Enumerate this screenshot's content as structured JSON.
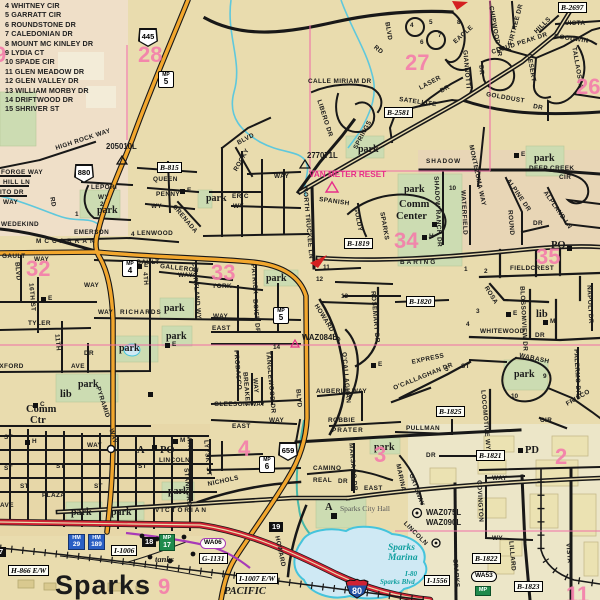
{
  "colors": {
    "bg": "#e9dcae",
    "bg_nw": "#efdfc8",
    "bg_se": "#ece6c8",
    "park": "#ccdcb2",
    "water_fill": "#cfe9f4",
    "water_line": "#45c4dc",
    "road": "#181818",
    "orange": "#f2a72e",
    "freeway": "#cf2233",
    "pink_line": "#f06ea6",
    "grid_pink": "#f47fab",
    "magenta": "#e82e8a",
    "purple": "#a83ab8",
    "building": "#ebe2b2"
  },
  "street_index": {
    "items": [
      "4  WHITNEY CIR",
      "5  GARRATT CIR",
      "6  ROUNDSTONE DR",
      "7  CALEDONIAN DR",
      "8  MOUNT MC KINLEY DR",
      "9  LYDIA CT",
      "10 SPADE CIR",
      "11 GLEN MEADOW DR",
      "12 GLEN VALLEY DR",
      "13 WILLIAM MORBY DR",
      "14 DRIFTWOOD DR",
      "15 SHRIVER ST"
    ]
  },
  "city": {
    "name": "Sparks"
  },
  "city_hall": {
    "marker": "A",
    "label": "Sparks City Hall"
  },
  "marina": {
    "line1": "Sparks",
    "line2": "Marina"
  },
  "i80_note": {
    "line1": "I-80",
    "line2": "Sparks Blvd"
  },
  "grid_numbers": [
    {
      "t": "9",
      "x": -6,
      "y": 44
    },
    {
      "t": "28",
      "x": 138,
      "y": 44
    },
    {
      "t": "27",
      "x": 405,
      "y": 52
    },
    {
      "t": "26",
      "x": 576,
      "y": 76
    },
    {
      "t": "32",
      "x": 26,
      "y": 258
    },
    {
      "t": "33",
      "x": 211,
      "y": 262
    },
    {
      "t": "34",
      "x": 394,
      "y": 230
    },
    {
      "t": "35",
      "x": 536,
      "y": 246
    },
    {
      "t": "4",
      "x": 238,
      "y": 438
    },
    {
      "t": "3",
      "x": 374,
      "y": 444
    },
    {
      "t": "2",
      "x": 555,
      "y": 446
    },
    {
      "t": "9",
      "x": 158,
      "y": 576
    },
    {
      "t": "11",
      "x": 566,
      "y": 584
    }
  ],
  "monuments": [
    {
      "t": "205010L",
      "x": 106,
      "y": 143
    },
    {
      "t": "277071L",
      "x": 307,
      "y": 152
    },
    {
      "t": "VAN METER RESET",
      "x": 309,
      "y": 171,
      "s": "vmr"
    },
    {
      "t": "WAZ084L",
      "x": 302,
      "y": 334
    },
    {
      "t": "WAZ075L",
      "x": 426,
      "y": 509
    },
    {
      "t": "WAZ090L",
      "x": 426,
      "y": 519
    }
  ],
  "ref_boxes": [
    {
      "t": "B-815",
      "x": 157,
      "y": 162
    },
    {
      "t": "B-2581",
      "x": 384,
      "y": 107
    },
    {
      "t": "B-2697",
      "x": 558,
      "y": 2
    },
    {
      "t": "B-1819",
      "x": 344,
      "y": 238
    },
    {
      "t": "B-1820",
      "x": 406,
      "y": 296
    },
    {
      "t": "B-1825",
      "x": 436,
      "y": 406
    },
    {
      "t": "B-1821",
      "x": 476,
      "y": 450
    },
    {
      "t": "B-1822",
      "x": 472,
      "y": 553
    },
    {
      "t": "B-1823",
      "x": 514,
      "y": 581
    },
    {
      "t": "H-866 E/W",
      "x": 8,
      "y": 565
    },
    {
      "t": "I-1006",
      "x": 111,
      "y": 545
    },
    {
      "t": "G-1131",
      "x": 199,
      "y": 553
    },
    {
      "t": "I-1007 E/W",
      "x": 236,
      "y": 573
    },
    {
      "t": "I-1556",
      "x": 424,
      "y": 575
    }
  ],
  "shields": [
    {
      "t": "445",
      "x": 138,
      "y": 28
    },
    {
      "t": "880",
      "x": 74,
      "y": 164
    },
    {
      "t": "659",
      "x": 278,
      "y": 442
    }
  ],
  "interstate": [
    {
      "t": "80",
      "x": 345,
      "y": 578
    }
  ],
  "mile_boxes": [
    {
      "a": "MP",
      "b": "5",
      "x": 158,
      "y": 71
    },
    {
      "a": "MP",
      "b": "4",
      "x": 122,
      "y": 260
    },
    {
      "a": "MP",
      "b": "5",
      "x": 273,
      "y": 307
    },
    {
      "a": "MP",
      "b": "6",
      "x": 259,
      "y": 456
    }
  ],
  "hm_boxes": [
    {
      "a": "HM",
      "b": "29",
      "x": 68,
      "y": 534
    },
    {
      "a": "HM",
      "b": "189",
      "x": 88,
      "y": 534
    }
  ],
  "green_boxes": [
    {
      "a": "MP",
      "b": "17",
      "x": 159,
      "y": 534
    },
    {
      "a": "MP",
      "b": "",
      "x": 475,
      "y": 586
    }
  ],
  "black_boxes": [
    {
      "t": "18",
      "x": 142,
      "y": 537
    },
    {
      "t": "19",
      "x": 269,
      "y": 522
    },
    {
      "t": "7",
      "x": -4,
      "y": 547
    }
  ],
  "ovals": [
    {
      "t": "WA06",
      "x": 200,
      "y": 538,
      "c": "p"
    },
    {
      "t": "WA53",
      "x": 471,
      "y": 571,
      "c": "k"
    }
  ],
  "places": [
    {
      "t": "Comm",
      "x": 399,
      "y": 200
    },
    {
      "t": "Center",
      "x": 396,
      "y": 212
    },
    {
      "t": "Comm",
      "x": 26,
      "y": 405
    },
    {
      "t": "Ctr",
      "x": 30,
      "y": 416
    },
    {
      "t": "PO",
      "x": 551,
      "y": 241
    },
    {
      "t": "PO",
      "x": 160,
      "y": 446
    },
    {
      "t": "PD",
      "x": 525,
      "y": 446
    },
    {
      "t": "lib",
      "x": 60,
      "y": 390
    },
    {
      "t": "lib",
      "x": 536,
      "y": 310
    },
    {
      "t": "A",
      "x": 137,
      "y": 446
    },
    {
      "t": "tanks",
      "x": 155,
      "y": 555,
      "s": "ital"
    },
    {
      "t": "PACIFIC",
      "x": 224,
      "y": 587,
      "s": "ital2"
    }
  ],
  "park_labels": [
    {
      "t": "park",
      "x": 97,
      "y": 206
    },
    {
      "t": "park",
      "x": 206,
      "y": 194
    },
    {
      "t": "park",
      "x": 358,
      "y": 145
    },
    {
      "t": "park",
      "x": 534,
      "y": 154
    },
    {
      "t": "park",
      "x": 404,
      "y": 185
    },
    {
      "t": "park",
      "x": 266,
      "y": 274
    },
    {
      "t": "park",
      "x": 164,
      "y": 304
    },
    {
      "t": "park",
      "x": 166,
      "y": 332
    },
    {
      "t": "park",
      "x": 119,
      "y": 344
    },
    {
      "t": "park",
      "x": 78,
      "y": 380
    },
    {
      "t": "park",
      "x": 71,
      "y": 508
    },
    {
      "t": "park",
      "x": 111,
      "y": 508
    },
    {
      "t": "park",
      "x": 168,
      "y": 487
    },
    {
      "t": "park",
      "x": 514,
      "y": 370
    },
    {
      "t": "park",
      "x": 374,
      "y": 443
    }
  ],
  "poi": [
    {
      "t": "E",
      "x": 137,
      "y": 264
    },
    {
      "t": "E",
      "x": 41,
      "y": 297
    },
    {
      "t": "E",
      "x": 165,
      "y": 343
    },
    {
      "t": "E",
      "x": 506,
      "y": 312
    },
    {
      "t": "E",
      "x": 371,
      "y": 363
    },
    {
      "t": "E",
      "x": 514,
      "y": 153
    },
    {
      "t": "E",
      "x": 180,
      "y": 189
    },
    {
      "t": "M",
      "x": 543,
      "y": 320
    },
    {
      "t": "M",
      "x": 173,
      "y": 439
    },
    {
      "t": "H",
      "x": 25,
      "y": 440
    },
    {
      "t": "H",
      "x": 422,
      "y": 235
    },
    {
      "t": "C",
      "x": 33,
      "y": 403
    }
  ],
  "small_numbers": [
    {
      "t": "11",
      "x": 323,
      "y": 265
    },
    {
      "t": "12",
      "x": 316,
      "y": 277
    },
    {
      "t": "13",
      "x": 341,
      "y": 294
    },
    {
      "t": "14",
      "x": 273,
      "y": 345
    },
    {
      "t": "9",
      "x": 543,
      "y": 374
    },
    {
      "t": "10",
      "x": 511,
      "y": 394
    },
    {
      "t": "1",
      "x": 464,
      "y": 267
    },
    {
      "t": "2",
      "x": 484,
      "y": 269
    },
    {
      "t": "3",
      "x": 476,
      "y": 309
    },
    {
      "t": "4",
      "x": 466,
      "y": 322
    },
    {
      "t": "10",
      "x": 449,
      "y": 186
    },
    {
      "t": "4",
      "x": 410,
      "y": 23
    },
    {
      "t": "5",
      "x": 429,
      "y": 20
    },
    {
      "t": "6",
      "x": 420,
      "y": 40
    },
    {
      "t": "7",
      "x": 438,
      "y": 33
    },
    {
      "t": "8",
      "x": 457,
      "y": 20
    },
    {
      "t": "4",
      "x": 131,
      "y": 232
    },
    {
      "t": "2",
      "x": 100,
      "y": 202
    },
    {
      "t": "1",
      "x": 75,
      "y": 212
    },
    {
      "t": "5",
      "x": 445,
      "y": 367
    }
  ],
  "streets": [
    {
      "t": "HIGH ROCK WAY",
      "x": 56,
      "y": 146,
      "r": -18
    },
    {
      "t": "FORGE WAY",
      "x": 1,
      "y": 170
    },
    {
      "t": "HILL LN",
      "x": 3,
      "y": 180
    },
    {
      "t": "ITO DR",
      "x": 0,
      "y": 190
    },
    {
      "t": "WAY",
      "x": 3,
      "y": 200
    },
    {
      "t": "RD",
      "x": 51,
      "y": 194,
      "r": 80
    },
    {
      "t": "LEPORI",
      "x": 91,
      "y": 185
    },
    {
      "t": "WY",
      "x": 98,
      "y": 195
    },
    {
      "t": "QUEEN",
      "x": 153,
      "y": 177
    },
    {
      "t": "PENNY",
      "x": 156,
      "y": 192
    },
    {
      "t": "WY",
      "x": 151,
      "y": 204
    },
    {
      "t": "GRENADA",
      "x": 173,
      "y": 203,
      "r": 50
    },
    {
      "t": "WEDEKIND",
      "x": 1,
      "y": 222
    },
    {
      "t": "MCCARRAN",
      "x": 36,
      "y": 239,
      "ls": 3
    },
    {
      "t": "EMERSON",
      "x": 74,
      "y": 230
    },
    {
      "t": "LENWOOD",
      "x": 137,
      "y": 231
    },
    {
      "t": "GAULT",
      "x": 2,
      "y": 254
    },
    {
      "t": "WAY",
      "x": 34,
      "y": 257
    },
    {
      "t": "BLVD",
      "x": 16,
      "y": 259,
      "r": 85
    },
    {
      "t": "GAULT",
      "x": 136,
      "y": 260
    },
    {
      "t": "GALLERON",
      "x": 160,
      "y": 264,
      "r": 6
    },
    {
      "t": "WAY",
      "x": 178,
      "y": 273
    },
    {
      "t": "4TH",
      "x": 144,
      "y": 269,
      "r": 85
    },
    {
      "t": "WAY",
      "x": 84,
      "y": 283
    },
    {
      "t": "RICHARDS",
      "x": 120,
      "y": 310,
      "ls": 1
    },
    {
      "t": "WAY",
      "x": 98,
      "y": 310
    },
    {
      "t": "TYLER",
      "x": 28,
      "y": 321
    },
    {
      "t": "16TH ST",
      "x": 30,
      "y": 280,
      "r": 85
    },
    {
      "t": "11TH",
      "x": 56,
      "y": 331,
      "r": 85
    },
    {
      "t": "OXFORD",
      "x": -6,
      "y": 364
    },
    {
      "t": "AVE",
      "x": 71,
      "y": 364
    },
    {
      "t": "DR",
      "x": 84,
      "y": 351
    },
    {
      "t": "AVE",
      "x": 0,
      "y": 503
    },
    {
      "t": "YORK",
      "x": 212,
      "y": 284
    },
    {
      "t": "COURTLAND WY",
      "x": 193,
      "y": 259,
      "r": 85
    },
    {
      "t": "PATRICK",
      "x": 252,
      "y": 261,
      "r": 85
    },
    {
      "t": "WAY",
      "x": 274,
      "y": 174
    },
    {
      "t": "EAST",
      "x": 212,
      "y": 326
    },
    {
      "t": "WAY",
      "x": 213,
      "y": 314
    },
    {
      "t": "BOISE DR",
      "x": 254,
      "y": 296,
      "r": 85
    },
    {
      "t": "PROBASCO",
      "x": 235,
      "y": 347,
      "r": 85
    },
    {
      "t": "TANGLEWOOD DR",
      "x": 267,
      "y": 348,
      "r": 85
    },
    {
      "t": "BREAKER",
      "x": 244,
      "y": 369,
      "r": 85
    },
    {
      "t": "WAY",
      "x": 254,
      "y": 375,
      "r": 85
    },
    {
      "t": "GLEESON WAY",
      "x": 214,
      "y": 402
    },
    {
      "t": "BLVD",
      "x": 297,
      "y": 386,
      "r": 85
    },
    {
      "t": "HOWARD DR",
      "x": 315,
      "y": 302,
      "r": 58
    },
    {
      "t": "O'CALLAGHAN",
      "x": 343,
      "y": 349,
      "r": 85
    },
    {
      "t": "ROSEMARY DR",
      "x": 372,
      "y": 288,
      "r": 85
    },
    {
      "t": "SPANISH",
      "x": 319,
      "y": 197,
      "r": 8
    },
    {
      "t": "NORTH TRUCKEE LN",
      "x": 304,
      "y": 184,
      "r": 85
    },
    {
      "t": "GOLDY",
      "x": 355,
      "y": 204,
      "r": 80
    },
    {
      "t": "SPARKS",
      "x": 381,
      "y": 209,
      "r": 80
    },
    {
      "t": "ERIC",
      "x": 232,
      "y": 194
    },
    {
      "t": "WY",
      "x": 233,
      "y": 204
    },
    {
      "t": "ROCKY",
      "x": 236,
      "y": 168,
      "r": -60
    },
    {
      "t": "BLVD",
      "x": 238,
      "y": 141,
      "r": -28
    },
    {
      "t": "CALLE MIRIAM DR",
      "x": 308,
      "y": 79
    },
    {
      "t": "LIBERO DR",
      "x": 318,
      "y": 97,
      "r": 72
    },
    {
      "t": "SPRINGS",
      "x": 356,
      "y": 146,
      "r": -62
    },
    {
      "t": "SATELLITE",
      "x": 399,
      "y": 97,
      "r": 8
    },
    {
      "t": "LASER",
      "x": 420,
      "y": 86,
      "r": -28
    },
    {
      "t": "DR",
      "x": 441,
      "y": 89,
      "r": -28
    },
    {
      "t": "EAGLE",
      "x": 455,
      "y": 40,
      "r": -42
    },
    {
      "t": "GIANNOTTI",
      "x": 464,
      "y": 47,
      "r": 85
    },
    {
      "t": "DR",
      "x": 480,
      "y": 62,
      "r": 85
    },
    {
      "t": "CHIPWOOD DR",
      "x": 490,
      "y": 3,
      "r": 80
    },
    {
      "t": "FIRTREE DR",
      "x": 511,
      "y": 42,
      "r": -75
    },
    {
      "t": "CLOUD PEAK DR",
      "x": 492,
      "y": 50,
      "r": -18
    },
    {
      "t": "DESERT",
      "x": 528,
      "y": 51,
      "r": 80
    },
    {
      "t": "HILLS",
      "x": 536,
      "y": 30,
      "r": -45
    },
    {
      "t": "VISTA",
      "x": 565,
      "y": 21
    },
    {
      "t": "GOODWIN",
      "x": 554,
      "y": 34,
      "r": 8
    },
    {
      "t": "TALLAOSEA",
      "x": 573,
      "y": 44,
      "r": 80
    },
    {
      "t": "GOLDDUST",
      "x": 486,
      "y": 92,
      "r": 10
    },
    {
      "t": "DR",
      "x": 533,
      "y": 104,
      "r": 10
    },
    {
      "t": "BLVD",
      "x": 386,
      "y": 19,
      "r": 80
    },
    {
      "t": "RD",
      "x": 374,
      "y": 44,
      "r": 40
    },
    {
      "t": "SHADOW",
      "x": 426,
      "y": 159,
      "ls": 1
    },
    {
      "t": "DEEP CREEK",
      "x": 529,
      "y": 166
    },
    {
      "t": "CIR",
      "x": 559,
      "y": 175
    },
    {
      "t": "SHADOW RANCH DR",
      "x": 435,
      "y": 173,
      "r": 87
    },
    {
      "t": "WATERFIELD",
      "x": 462,
      "y": 187,
      "r": 87
    },
    {
      "t": "MONTEZUMA WAY",
      "x": 470,
      "y": 142,
      "r": 78
    },
    {
      "t": "ALPINE DR",
      "x": 507,
      "y": 177,
      "r": 55
    },
    {
      "t": "ROUND",
      "x": 509,
      "y": 207,
      "r": 85
    },
    {
      "t": "DR",
      "x": 533,
      "y": 221
    },
    {
      "t": "ALPLAND LN",
      "x": 544,
      "y": 189,
      "r": 55
    },
    {
      "t": "BARING",
      "x": 400,
      "y": 260,
      "ls": 2
    },
    {
      "t": "FIELDCREST",
      "x": 510,
      "y": 266
    },
    {
      "t": "WHITEWOOD",
      "x": 480,
      "y": 329
    },
    {
      "t": "DR",
      "x": 535,
      "y": 333
    },
    {
      "t": "BLOSSOMVIEW DR",
      "x": 521,
      "y": 283,
      "r": 87
    },
    {
      "t": "ROSA",
      "x": 485,
      "y": 284,
      "r": 58
    },
    {
      "t": "WABASH",
      "x": 519,
      "y": 353,
      "r": 12
    },
    {
      "t": "EXPRESS",
      "x": 412,
      "y": 360,
      "r": -12
    },
    {
      "t": "O'CALLAGHAN DR",
      "x": 394,
      "y": 386,
      "r": -22
    },
    {
      "t": "ST",
      "x": 461,
      "y": 364
    },
    {
      "t": "FRISCO",
      "x": 567,
      "y": 402,
      "r": -30
    },
    {
      "t": "PALERMO DR",
      "x": 575,
      "y": 346,
      "r": 87
    },
    {
      "t": "NAPOLI DR",
      "x": 588,
      "y": 282,
      "r": 87
    },
    {
      "t": "LOCOMOTIVE WY",
      "x": 482,
      "y": 387,
      "r": 85
    },
    {
      "t": "CIR",
      "x": 540,
      "y": 418
    },
    {
      "t": "PULLMAN",
      "x": 406,
      "y": 426
    },
    {
      "t": "ROBBIE",
      "x": 328,
      "y": 418
    },
    {
      "t": "PRATER",
      "x": 332,
      "y": 428,
      "ls": 1
    },
    {
      "t": "AUBERLE WAY",
      "x": 316,
      "y": 389
    },
    {
      "t": "WAY",
      "x": 269,
      "y": 418
    },
    {
      "t": "EAST",
      "x": 232,
      "y": 424
    },
    {
      "t": "LYYSKI ST",
      "x": 205,
      "y": 437,
      "r": 85
    },
    {
      "t": "NICHOLS",
      "x": 208,
      "y": 482,
      "r": -12
    },
    {
      "t": "WAY",
      "x": 87,
      "y": 443
    },
    {
      "t": "CAMINO",
      "x": 313,
      "y": 466
    },
    {
      "t": "REAL",
      "x": 313,
      "y": 478
    },
    {
      "t": "DR",
      "x": 338,
      "y": 479
    },
    {
      "t": "MARSACO DR",
      "x": 350,
      "y": 440,
      "r": 85
    },
    {
      "t": "EAST",
      "x": 364,
      "y": 486
    },
    {
      "t": "HOWARD",
      "x": 276,
      "y": 533,
      "r": 78
    },
    {
      "t": "MARINA",
      "x": 397,
      "y": 461,
      "r": 78
    },
    {
      "t": "GATEWAY",
      "x": 410,
      "y": 471,
      "r": 70
    },
    {
      "t": "DR",
      "x": 426,
      "y": 453
    },
    {
      "t": "COVINGTON",
      "x": 478,
      "y": 477,
      "r": 87
    },
    {
      "t": "WAY",
      "x": 492,
      "y": 476
    },
    {
      "t": "WY",
      "x": 492,
      "y": 536
    },
    {
      "t": "LILLARD",
      "x": 510,
      "y": 538,
      "r": 85
    },
    {
      "t": "VISTA",
      "x": 567,
      "y": 540,
      "r": 85
    },
    {
      "t": "SPARKS",
      "x": 454,
      "y": 556,
      "r": 85
    },
    {
      "t": "VICTORIAN",
      "x": 155,
      "y": 508,
      "ls": 2
    },
    {
      "t": "LINCOLN",
      "x": 159,
      "y": 458
    },
    {
      "t": "LINCOLN",
      "x": 404,
      "y": 520,
      "r": 45
    },
    {
      "t": "STANFORD",
      "x": 185,
      "y": 465,
      "r": 85
    },
    {
      "t": "WAY",
      "x": 188,
      "y": 433,
      "r": 85
    },
    {
      "t": "PLAZA",
      "x": 42,
      "y": 493
    },
    {
      "t": "PYRAMID",
      "x": 97,
      "y": 384,
      "r": 72
    },
    {
      "t": "WAY",
      "x": 110,
      "y": 426,
      "r": 72
    },
    {
      "t": "ST",
      "x": 4,
      "y": 435
    },
    {
      "t": "ST",
      "x": 4,
      "y": 466
    },
    {
      "t": "ST",
      "x": 20,
      "y": 484
    },
    {
      "t": "ST",
      "x": 56,
      "y": 464
    },
    {
      "t": "ST",
      "x": 94,
      "y": 484
    },
    {
      "t": "ST",
      "x": 138,
      "y": 464
    }
  ]
}
